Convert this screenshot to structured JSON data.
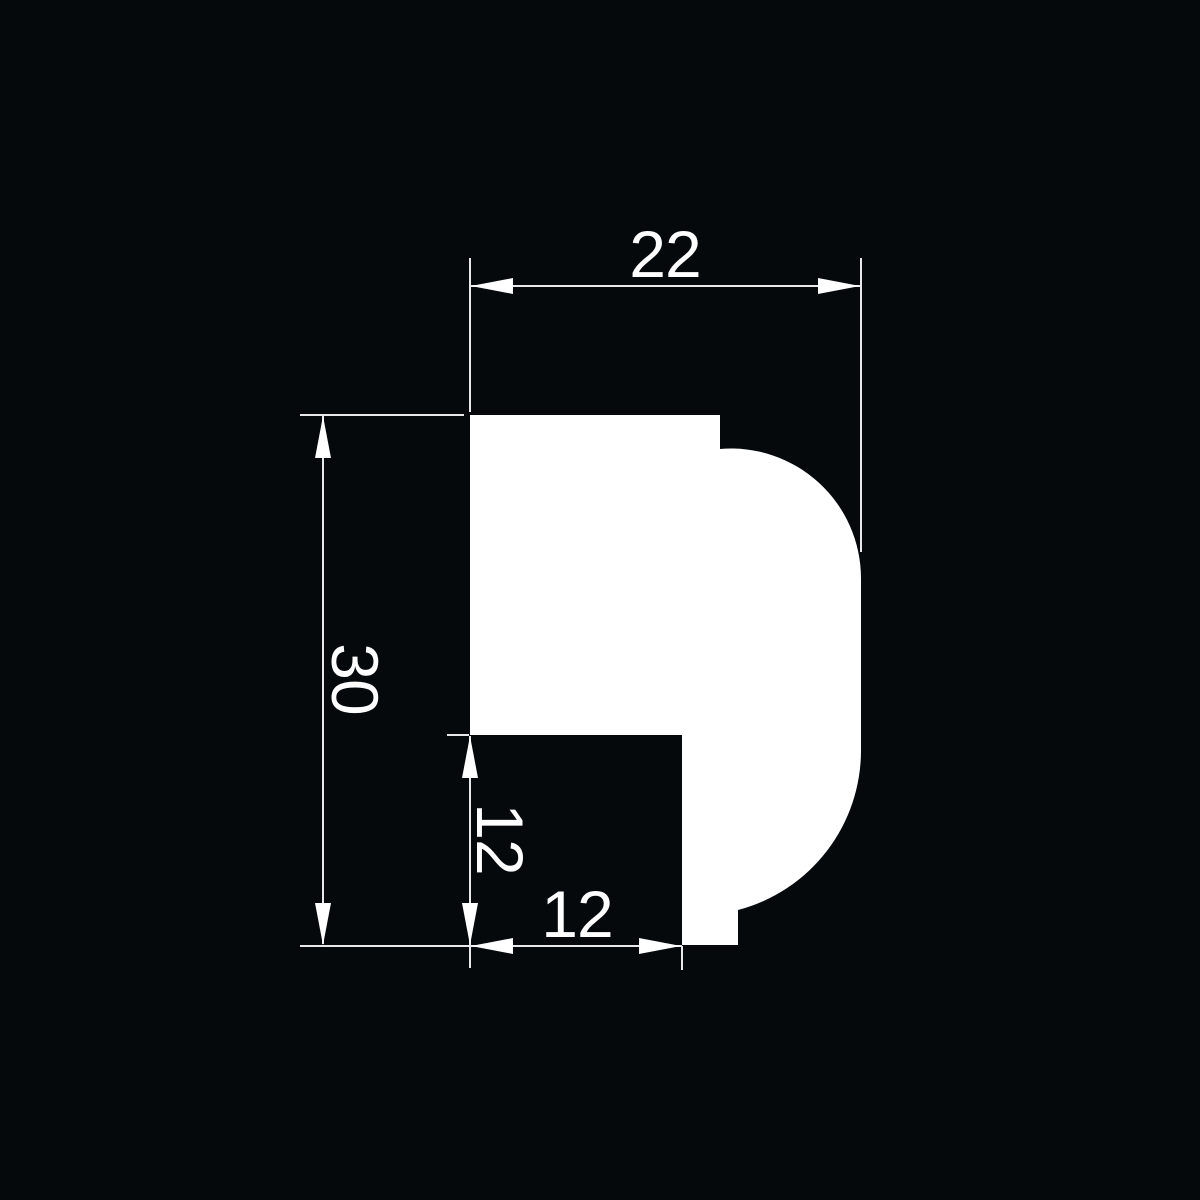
{
  "drawing": {
    "kind": "technical-profile-cross-section",
    "profile_path": "M 470 415 L 720 415 L 720 449 A 130 130 0 0 1 861 578 L 861 750 A 165 165 0 0 1 738 910 L 738 945 L 682 945 L 682 735 L 470 735 Z"
  },
  "colors": {
    "background": "#06090c",
    "ink": "#ffffff",
    "line": "#e8e8e8"
  },
  "dimensions": {
    "top_width": {
      "label": "22",
      "orientation": "horizontal"
    },
    "left_height": {
      "label": "30",
      "orientation": "vertical"
    },
    "inner_height": {
      "label": "12",
      "orientation": "vertical"
    },
    "inner_width": {
      "label": "12",
      "orientation": "horizontal"
    }
  }
}
